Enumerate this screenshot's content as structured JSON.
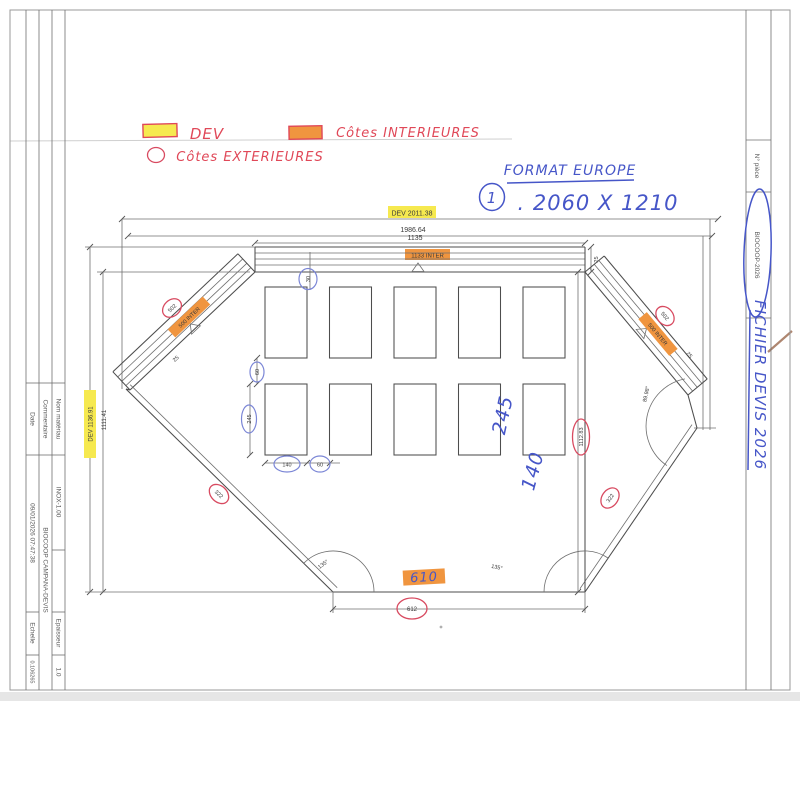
{
  "legend": {
    "dev_label": "DEV",
    "inter_label": "Côtes INTERIEURES",
    "exter_label": "Côtes EXTERIEURES"
  },
  "format_note": {
    "title": "FORMAT EUROPE",
    "index": "1",
    "value": ". 2060 X 1210"
  },
  "title_block": {
    "date_label": "Date",
    "date_value": "09/01/2026 07:47:38",
    "comment_label": "Commentaire",
    "comment_value": "BIOCOOP CAMPANA-DEVIS",
    "material_label": "Nom matériau",
    "material_value": "INOX-1.00",
    "scale_label": "Echelle",
    "scale_value": "0.106265",
    "thickness_label": "Epaisseur",
    "thickness_value": "1.0"
  },
  "part_strip": {
    "label": "N° pièce",
    "value": "BIOCOOP-2026",
    "handwritten_note": "FICHIER DEVIS 2026"
  },
  "dims": {
    "dev_width": "DEV 2011.38",
    "outer_width": "1986.64",
    "top_width": "1135",
    "top_width_inter": "1133 INTER",
    "flange_top": "25",
    "flange_left": "25",
    "flange_right": "25",
    "dev_height": "DEV 1136.91",
    "left_height": "1111.41",
    "right_height": "1112.83",
    "left_diag": "502",
    "left_diag_inter": "500 INTER",
    "right_diag": "502",
    "right_diag_inter": "500 INTER",
    "bottom_width": "612",
    "bottom_left_diag": "322",
    "bottom_right_diag": "322",
    "angle_bottom_left": "135°",
    "angle_bottom_right": "135°",
    "angle_right": "89.98°",
    "top_offset": "30",
    "row_gap": "60",
    "hole_height": "245",
    "hole_width": "140",
    "col_gap": "60"
  },
  "annotations": {
    "width_note": "610",
    "height_note": "245",
    "width_note2": "140"
  },
  "colors": {
    "red_pen": "#e04858",
    "blue_pen": "#4656c8",
    "yellow_highlight": "#f6e94f",
    "orange_highlight": "#f0953f"
  }
}
